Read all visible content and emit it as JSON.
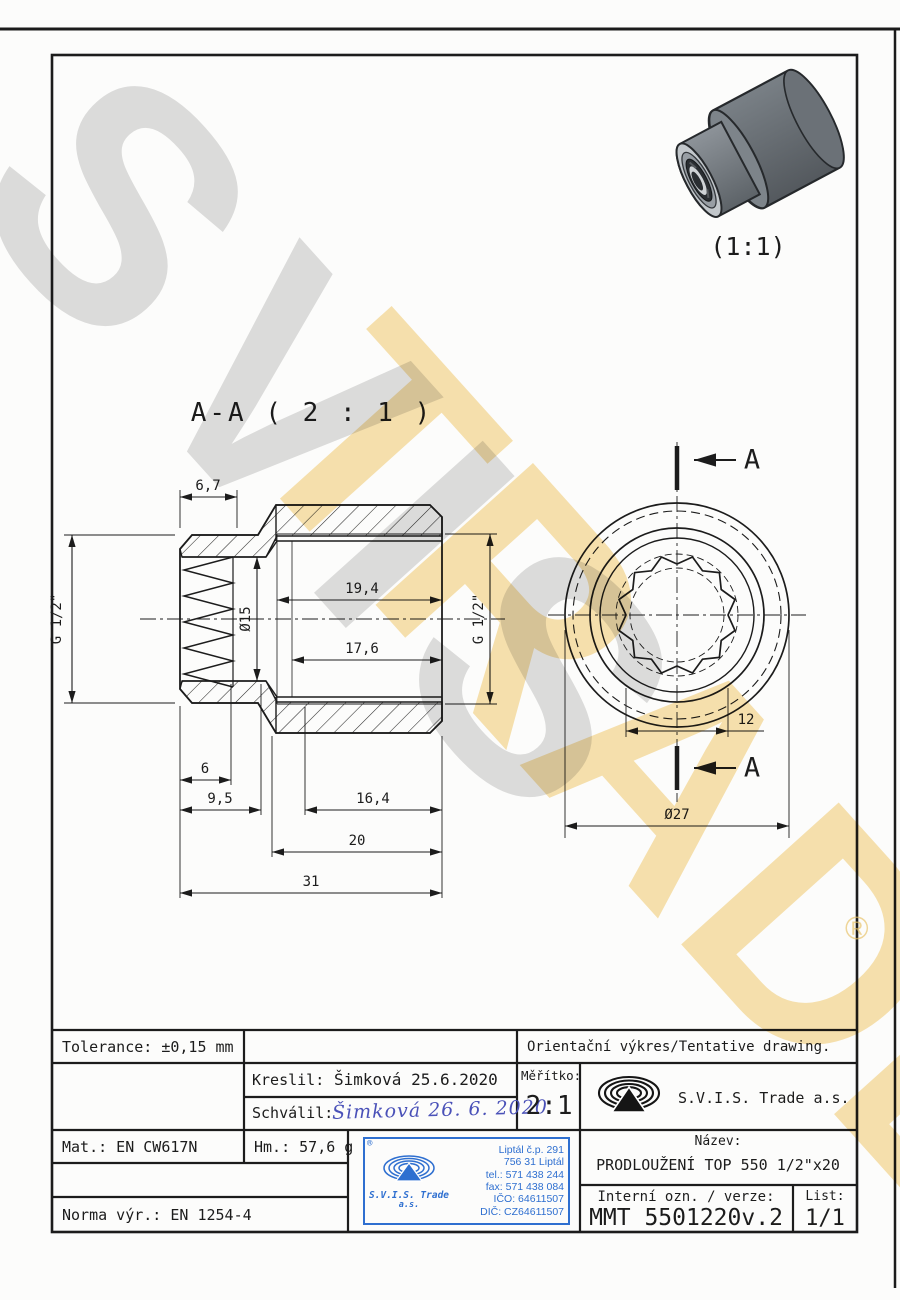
{
  "watermark": {
    "word1": "SVIS",
    "word2": "TRADE",
    "registered": "®"
  },
  "colors": {
    "line_black": "#1c1c1c",
    "stamp_blue": "#2e6fd0",
    "watermark_gray": "#c9c9c9",
    "watermark_yellow": "#f3cf7a",
    "part_gray": "#8a9096",
    "signature_blue": "#4a51b8"
  },
  "views": {
    "iso": {
      "scale_label": "(1:1)"
    },
    "section": {
      "title": "A-A ( 2 : 1 )",
      "dims": {
        "d67": "6,7",
        "g12_left": "G 1/2\"",
        "dia15": "Ø15",
        "d194": "19,4",
        "d176": "17,6",
        "g12_right": "G 1/2\"",
        "d6": "6",
        "d95": "9,5",
        "d164": "16,4",
        "d20": "20",
        "d31": "31"
      }
    },
    "end": {
      "cut_label": "A",
      "dims": {
        "d12": "12",
        "dia27": "Ø27"
      }
    }
  },
  "titleblock": {
    "tolerance": "Tolerance: ±0,15 mm",
    "orientacni": "Orientační výkres/Tentative drawing.",
    "kreslil_label": "Kreslil:",
    "kreslil_value": "Šimková 25.6.2020",
    "schvalil_label": "Schválil:",
    "schvalil_signature": "Šimková 26. 6. 2020",
    "meritko_label": "Měřítko:",
    "meritko_value": "2:1",
    "company": "S.V.I.S. Trade a.s.",
    "mat": "Mat.: EN CW617N",
    "hm": "Hm.: 57,6 g",
    "norma": "Norma výr.: EN 1254-4",
    "nazev_label": "Název:",
    "nazev_value": "PRODLOUŽENÍ TOP 550 1/2\"x20",
    "interni_label": "Interní ozn. / verze:",
    "interni_value": "MMT 5501220v.2",
    "list_label": "List:",
    "list_value": "1/1",
    "stamp": {
      "registered": "®",
      "company": "S.V.I.S. Trade",
      "as": "a.s.",
      "address1": "Liptál č.p. 291",
      "address2": "756 31 Liptál",
      "tel": "tel.: 571 438 244",
      "fax": "fax: 571 438 084",
      "ico": "IČO: 64611507",
      "dic": "DIČ: CZ64611507"
    }
  }
}
